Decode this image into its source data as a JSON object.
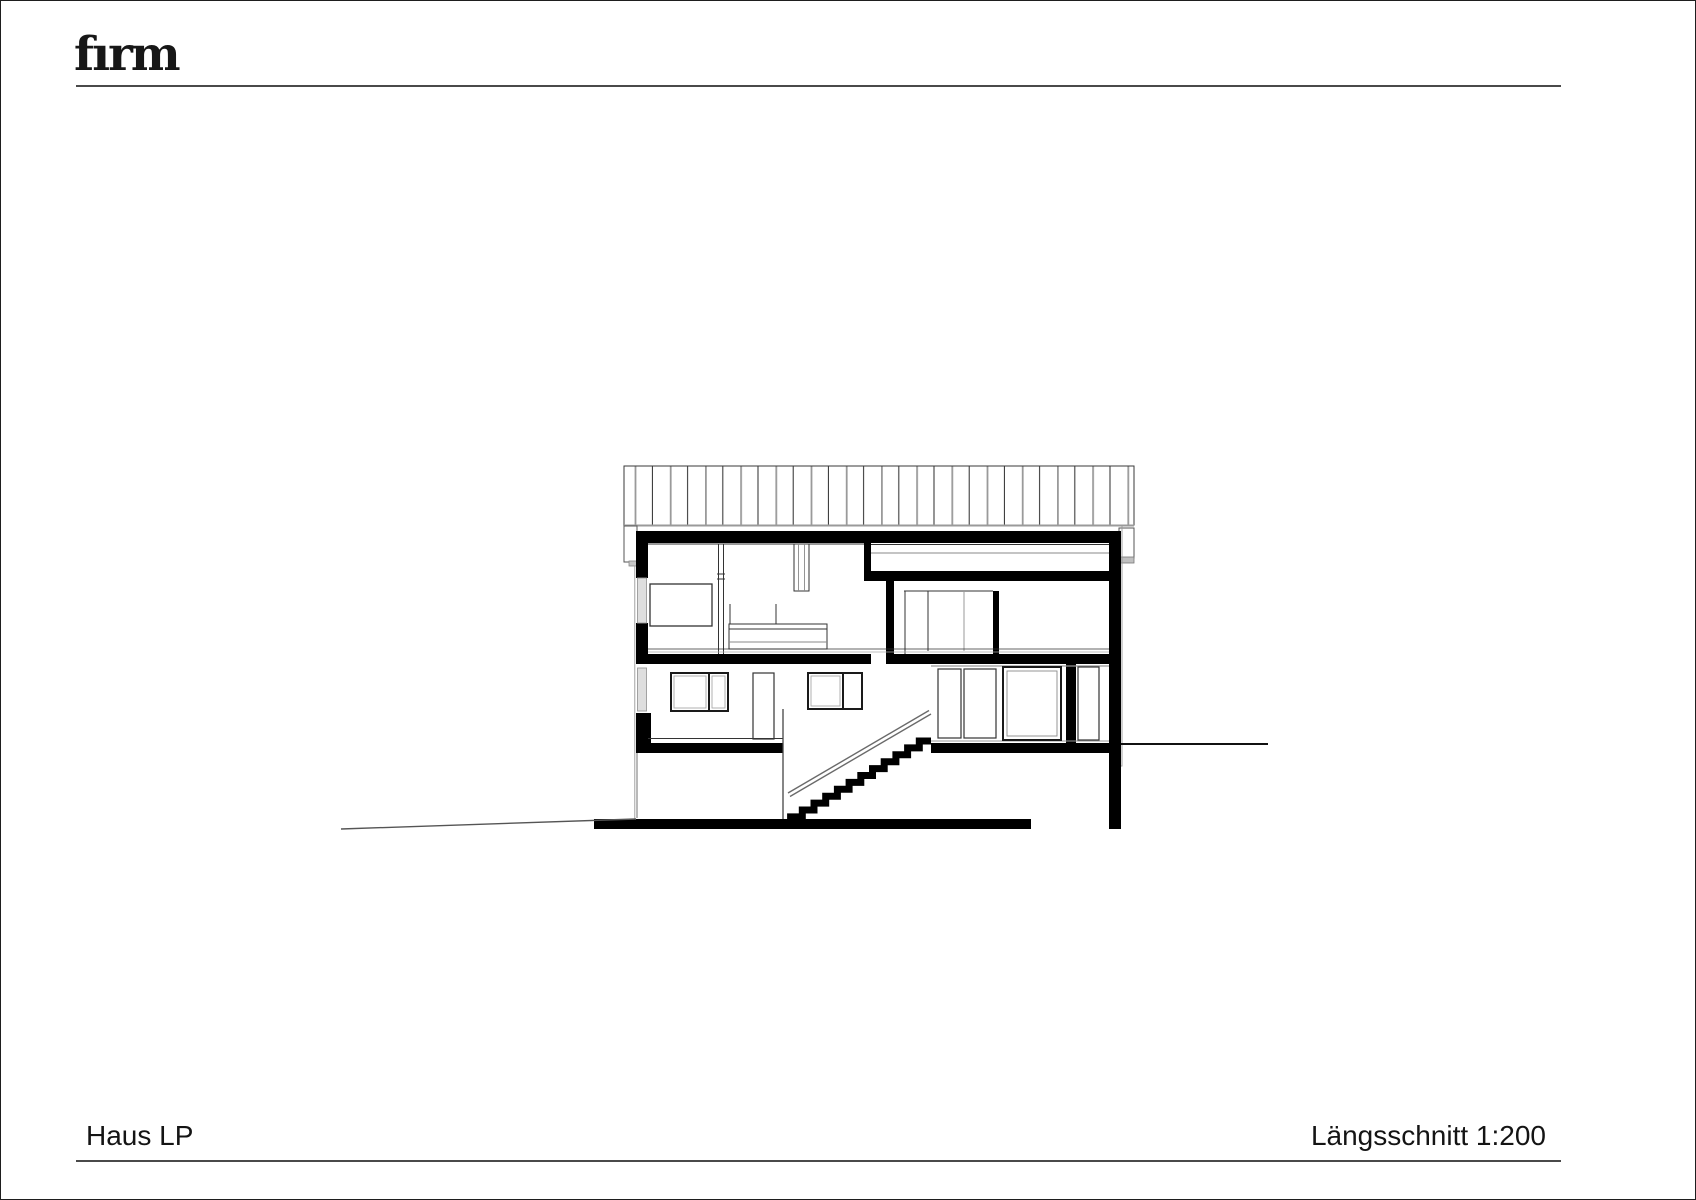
{
  "page": {
    "logo_text": "fırm"
  },
  "footer": {
    "project_title": "Haus LP",
    "drawing_label": "Längsschnitt 1:200"
  },
  "drawing": {
    "title": "Längsschnitt",
    "scale": "1:200",
    "colors": {
      "cut_elements": "#000000",
      "fine_lines": "#8a8a8a",
      "background": "#ffffff"
    }
  }
}
